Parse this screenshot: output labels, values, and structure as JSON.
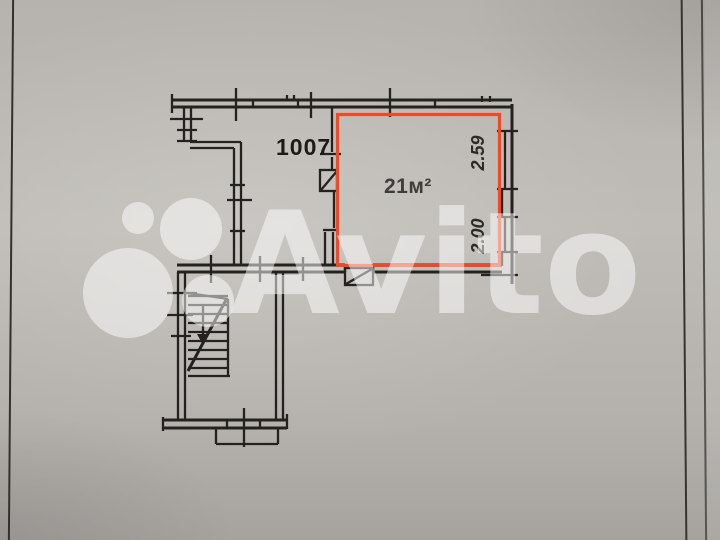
{
  "floor_plan": {
    "room_number": "1007",
    "area_label": "21м²",
    "dimensions": {
      "window_top": "2.59",
      "window_bottom": "2.00"
    }
  },
  "watermark": {
    "brand": "Avito",
    "logo_icon": "avito-four-circles-icon"
  },
  "colors": {
    "ink": "#23221f",
    "red": "#ec4b2a",
    "wm": "rgba(255,255,255,0.5)",
    "label_dark": "#1c1b19",
    "area_text": "#3e3d39",
    "dim_text": "#2b2a27"
  }
}
